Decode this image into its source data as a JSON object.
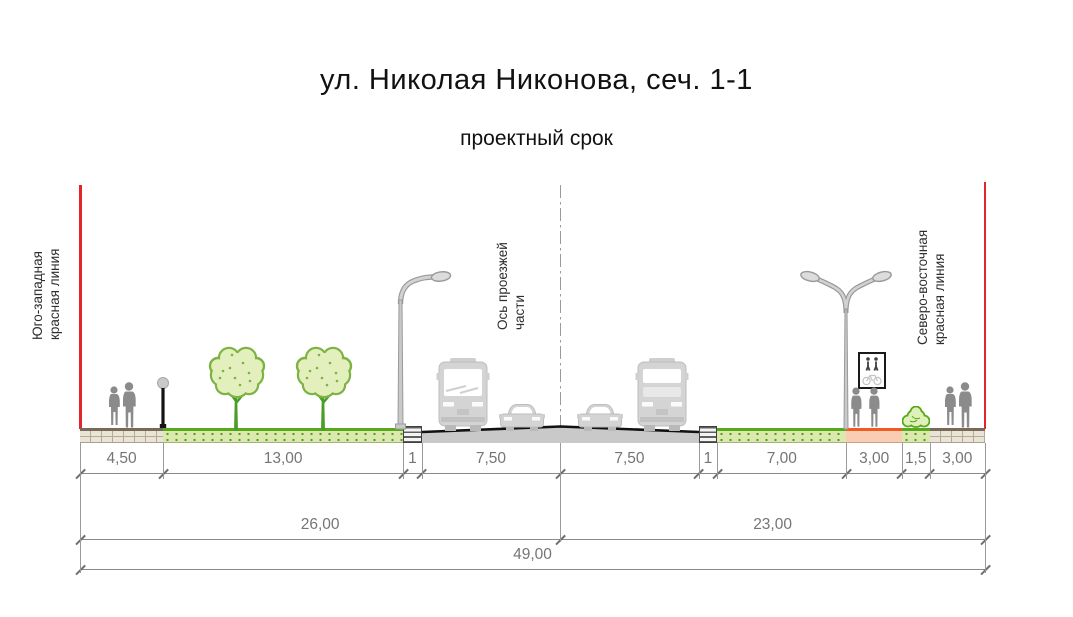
{
  "header": {
    "title": "ул. Николая Никонова, сеч. 1-1",
    "subtitle": "проектный срок"
  },
  "markers": {
    "left_label": "Юго-западная\nкрасная линия",
    "axis_label": "Ось проезжей\nчасти",
    "right_label": "Северо-восточная\nкрасная линия"
  },
  "section": {
    "total_m": 49,
    "segments": [
      {
        "label": "4,50",
        "m": 4.5,
        "kind": "sidewalk"
      },
      {
        "label": "13,00",
        "m": 13,
        "kind": "green"
      },
      {
        "label": "1",
        "m": 1,
        "kind": "curb"
      },
      {
        "label": "7,50",
        "m": 7.5,
        "kind": "road"
      },
      {
        "label": "7,50",
        "m": 7.5,
        "kind": "road"
      },
      {
        "label": "1",
        "m": 1,
        "kind": "curb"
      },
      {
        "label": "7,00",
        "m": 7,
        "kind": "green"
      },
      {
        "label": "3,00",
        "m": 3,
        "kind": "orange"
      },
      {
        "label": "1,5",
        "m": 1.5,
        "kind": "green"
      },
      {
        "label": "3,00",
        "m": 3,
        "kind": "sidewalk"
      }
    ]
  },
  "dimensions": {
    "row2": [
      {
        "label": "26,00",
        "m": 26
      },
      {
        "label": "23,00",
        "m": 23
      }
    ],
    "row3": [
      {
        "label": "49,00",
        "m": 49
      }
    ]
  },
  "scenery": [
    "pedestrian-couple",
    "pedestrian-lamp",
    "tree",
    "tree",
    "street-light-single-arm",
    "bus",
    "car",
    "car",
    "bus",
    "street-light-double-arm",
    "ped-bike-path-sign",
    "pedestrian",
    "pedestrian",
    "shrub",
    "pedestrian-couple"
  ],
  "colors": {
    "red_line": "#e3242b",
    "green_top": "#58a81c",
    "green_fill": "#dbe9ae",
    "orange_top": "#f15a22",
    "orange_fill": "#f9cdb4",
    "road_fill": "#c9c9c9",
    "asphalt_line": "#111111",
    "sidewalk_fill": "#eae4d6",
    "dimension_gray": "#757575"
  }
}
